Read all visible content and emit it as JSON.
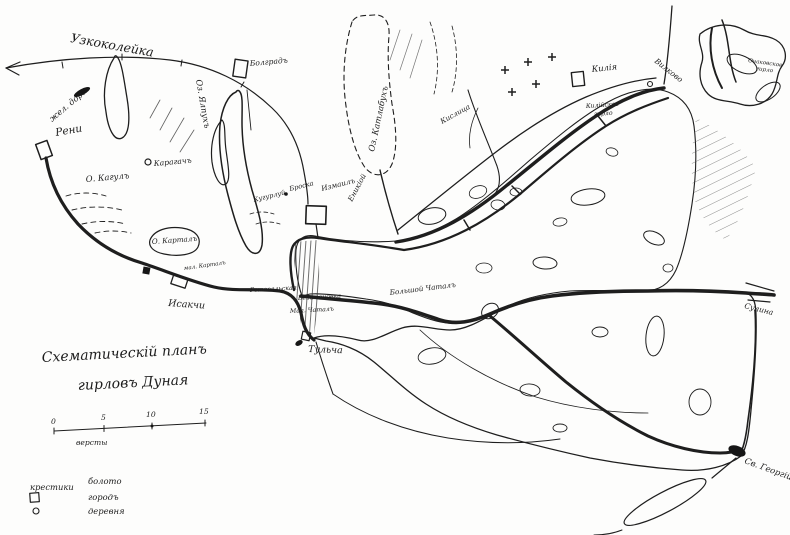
{
  "map": {
    "title": {
      "line1": "Схематическій планъ",
      "line2": "гирловъ Дуная"
    },
    "scale": {
      "ticks": [
        "0",
        "5",
        "10",
        "15"
      ],
      "unit": "версты"
    },
    "legend": {
      "marsh_symbol_label": "крестики",
      "marsh_label": "болото",
      "town_label": "городъ",
      "village_label": "деревня"
    },
    "labels": {
      "railway": "Узкоколейка",
      "railroad": "жел. дор.",
      "reni": "Рени",
      "bolgrad": "Болградъ",
      "karagach": "Карагачъ",
      "yalpukh": "Оз. Ялпухъ",
      "kagul": "О. Кагулъ",
      "kartal": "О. Карталъ",
      "mal_kartal": "мал. Карталъ",
      "isakcha": "Исакчи",
      "katlabukh": "Оз. Катлабухъ",
      "enikioy": "Еникіой",
      "kugurluy": "Кугурлуй",
      "broska": "Броска",
      "izmail": "Измаилъ",
      "kislitsa": "Кислица",
      "kiliya": "Килія",
      "kiliya_branch_l1": "Килійское",
      "kiliya_branch_l2": "гирло",
      "vilkovo": "Вилково",
      "ochakov_l1": "Очаковское",
      "ochakov_l2": "гирло",
      "sulina": "Сулина",
      "st_george": "Св. Георгій",
      "big_chatal": "Большой Чаталъ",
      "gotoval": "Готовальская",
      "bezymen": "Безименовка",
      "mal_chatal": "Мал. Чаталъ",
      "tulcha": "Тульча"
    },
    "colors": {
      "ink": "#1e1e1e",
      "paper": "#fdfdfc"
    }
  }
}
